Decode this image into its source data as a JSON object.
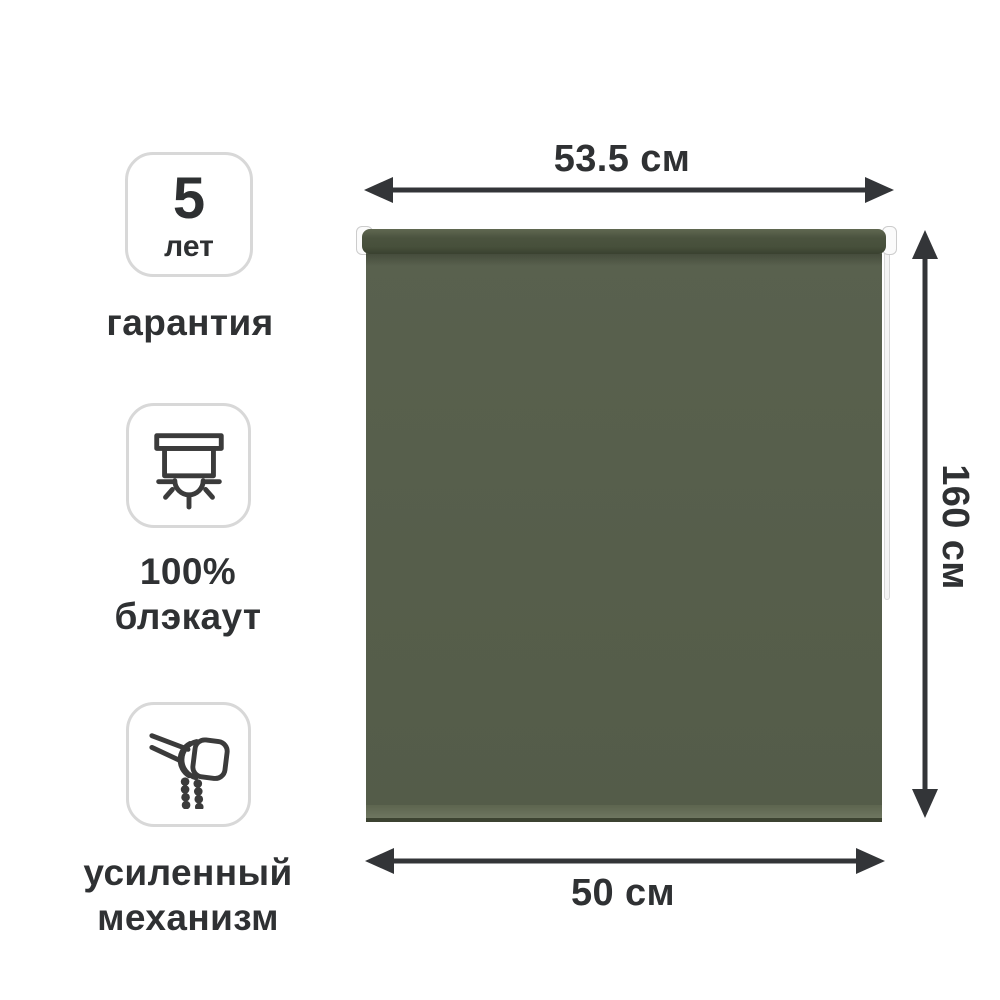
{
  "product": {
    "name": "roller-blind",
    "fabric_color": "#565e4b",
    "tube_color": "#4b533f",
    "hem_color": "#6e7660",
    "chain_color": "#f4f4f4"
  },
  "dimensions": {
    "top_width": "53.5 см",
    "side_height": "160 см",
    "bottom_width": "50 см"
  },
  "badges": [
    {
      "id": "warranty",
      "box_number": "5",
      "box_caption": "лет",
      "label_line1": "гарантия"
    },
    {
      "id": "blackout",
      "icon": "blackout-blind-icon",
      "label_line1": "100%",
      "label_line2": "блэкаут"
    },
    {
      "id": "mechanism",
      "icon": "roller-mechanism-chain-icon",
      "label_line1": "усиленный",
      "label_line2": "механизм"
    }
  ],
  "colors": {
    "arrow": "#333538",
    "text": "#2f3133",
    "badge_border": "#d8d8d8",
    "background": "#ffffff"
  }
}
